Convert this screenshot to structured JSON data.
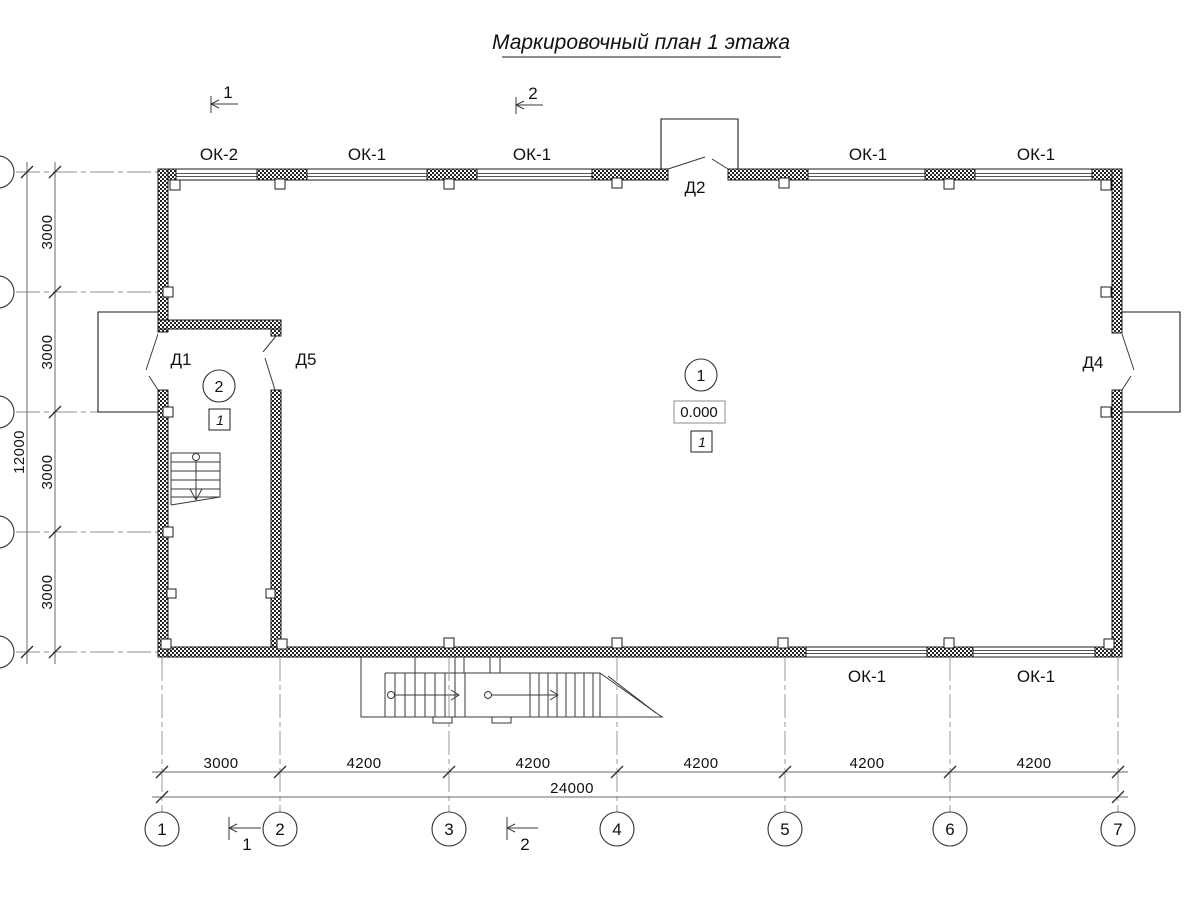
{
  "title": "Маркировочный план 1 этажа",
  "section_marks": {
    "mark1": "1",
    "mark2": "2"
  },
  "window_labels": {
    "top": [
      "ОК-2",
      "ОК-1",
      "ОК-1",
      "ОК-1",
      "ОК-1"
    ],
    "bottom": [
      "ОК-1",
      "ОК-1"
    ]
  },
  "door_labels": {
    "d1": "Д1",
    "d2": "Д2",
    "d4": "Д4",
    "d5": "Д5"
  },
  "room_markers": {
    "room1": {
      "number": "1",
      "floor_type": "1"
    },
    "room2": {
      "number": "2",
      "floor_type": "1"
    }
  },
  "elevation_mark": "0.000",
  "axis_bubbles": [
    "1",
    "2",
    "3",
    "4",
    "5",
    "6",
    "7"
  ],
  "dimensions": {
    "bottom": {
      "segments": [
        "3000",
        "4200",
        "4200",
        "4200",
        "4200",
        "4200"
      ],
      "total": "24000"
    },
    "left": {
      "segments": [
        "3000",
        "3000",
        "3000",
        "3000"
      ],
      "total": "12000"
    }
  }
}
